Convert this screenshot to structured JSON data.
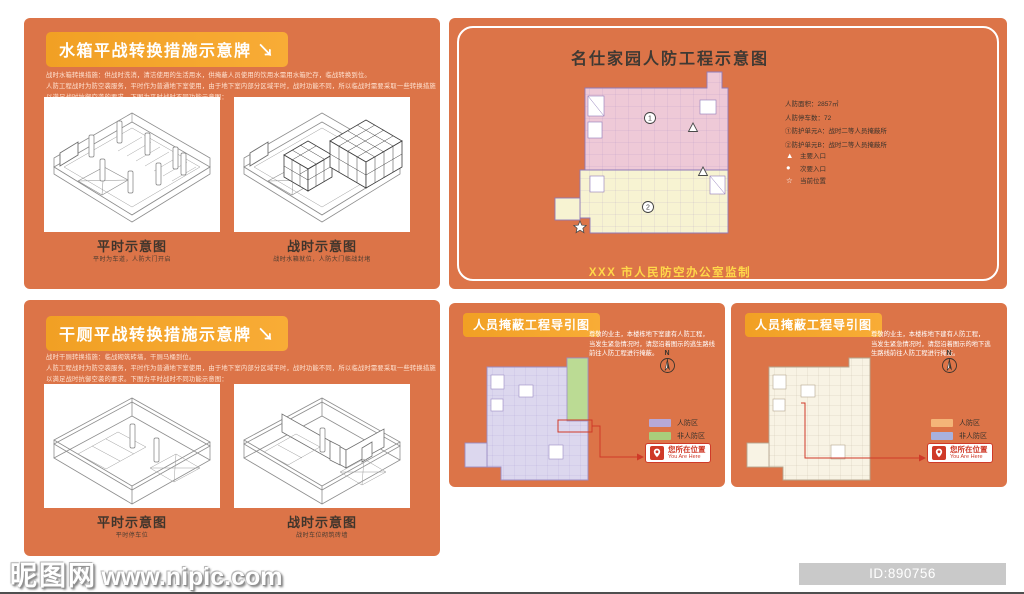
{
  "water_tank_panel": {
    "title": "水箱平战转换措施示意牌 ↘",
    "body_lines": [
      "战时水箱转换措施：供战时洗消，清洁使用的生活用水，供掩蔽人员使用的饮用水需用水箱贮存，临战转换到位。",
      "人防工程战时为防空袭服务，平时作为普通地下室使用，由于地下室内部分区域平时，战时功能不同，所以临战时需要采取一些转换措施",
      "以满足战时抗御空袭的要求。下图为平时战时不同功能示意图："
    ],
    "diagrams": [
      {
        "caption": "平时示意图",
        "subcaption": "平时为车道，人防大门开启"
      },
      {
        "caption": "战时示意图",
        "subcaption": "战时水箱就位，人防大门临战封堵"
      }
    ]
  },
  "dry_toilet_panel": {
    "title": "干厕平战转换措施示意牌 ↘",
    "body_lines": [
      "战时干厕转换措施：临战砌筑砖墙，干厕马桶到位。",
      "人防工程战时为防空袭服务，平时作为普通地下室使用，由于地下室内部分区域平时，战时功能不同，所以临战时需要采取一些转换措施",
      "以满足战时抗御空袭的要求。下图为平时战时不同功能示意图："
    ],
    "diagrams": [
      {
        "caption": "平时示意图",
        "subcaption": "平时停车位"
      },
      {
        "caption": "战时示意图",
        "subcaption": "战时车位砌筑砖墙"
      }
    ]
  },
  "overview_panel": {
    "title": "名仕家园人防工程示意图",
    "stats": [
      "人防面积：2857㎡",
      "人防停车数：72",
      "①防护单元A：战时二等人员掩蔽所",
      "②防护单元B：战时二等人员掩蔽所"
    ],
    "entrance_legend": [
      {
        "symbol": "▲",
        "label": "主要入口"
      },
      {
        "symbol": "●",
        "label": "次要入口"
      },
      {
        "symbol": "☆",
        "label": "当前位置"
      }
    ],
    "unit_markers": {
      "a": "1",
      "b": "2"
    },
    "footer": "XXX 市人民防空办公室监制"
  },
  "guide_left": {
    "title": "人员掩蔽工程导引图",
    "notice_lines": [
      "尊敬的业主，本楼栋地下室建有人防工程，",
      "当发生紧急情况时，请您沿着图示的逃生路线",
      "前往人防工程进行掩蔽。"
    ],
    "north": "N",
    "legend": [
      {
        "label": "人防区",
        "color": "#B7A8D8"
      },
      {
        "label": "非人防区",
        "color": "#A9CE7B"
      }
    ],
    "you_are_here": {
      "zh": "您所在位置",
      "en": "You Are Here"
    }
  },
  "guide_right": {
    "title": "人员掩蔽工程导引图",
    "notice_lines": [
      "尊敬的业主，本楼栋地下建有人防工程，",
      "当发生紧急情况时，请您沿着图示的地下逃",
      "生路线前往人防工程进行掩蔽。"
    ],
    "north": "N",
    "legend": [
      {
        "label": "人防区",
        "color": "#F4B578"
      },
      {
        "label": "非人防区",
        "color": "#A8B1DE"
      }
    ],
    "you_are_here": {
      "zh": "您所在位置",
      "en": "You Are Here"
    }
  },
  "watermark": {
    "logo": "昵图网",
    "url": "www.nipic.com"
  },
  "id_bar": {
    "text": "ID:890756 NO:20210819134146272101"
  }
}
